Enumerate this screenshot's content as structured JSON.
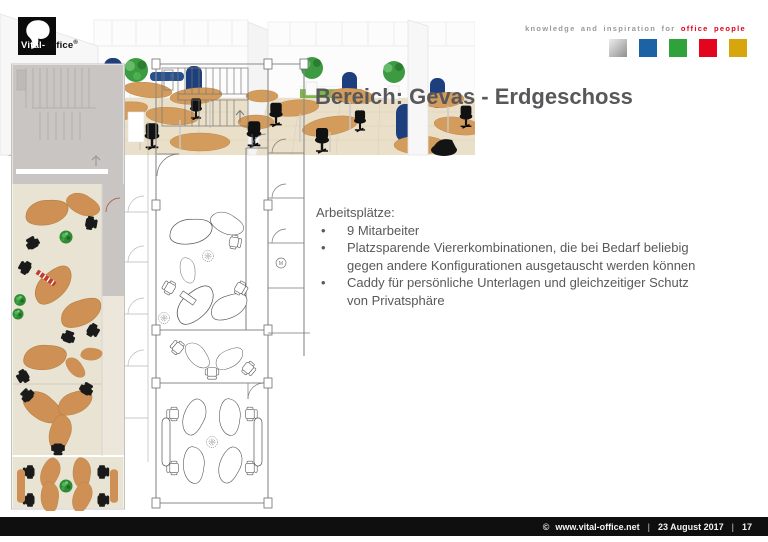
{
  "header": {
    "logo": {
      "white_part": "Vital-",
      "dark_part": "Office",
      "registered_mark": "®"
    },
    "tagline_gray": "knowledge and inspiration for",
    "tagline_red": "office people",
    "palette_squares": [
      {
        "label": "silver",
        "color": "#ededed",
        "color2": "#8f8f8f"
      },
      {
        "label": "blue",
        "color": "#1c63a6"
      },
      {
        "label": "green",
        "color": "#2fa23c"
      },
      {
        "label": "red",
        "color": "#e30520"
      },
      {
        "label": "gold",
        "color": "#d7a60d"
      }
    ]
  },
  "title": "Bereich: Gevas - Erdgeschoss",
  "content": {
    "list_heading": "Arbeitsplätze:",
    "bullet_char": "•",
    "bullets": [
      "9 Mitarbeiter",
      "Platzsparende Viererkombinationen, die bei Bedarf beliebig gegen andere Konfigurationen ausgetauscht werden können",
      "Caddy für persönliche Unterlagen und gleichzeitiger Schutz von Privatsphäre"
    ]
  },
  "floorplans": {
    "stairs_label": "Steig",
    "marker_label": "M"
  },
  "footer": {
    "copyright_symbol": "©",
    "website": "www.vital-office.net",
    "separator": "|",
    "date": "23 August 2017",
    "page_number": "17"
  },
  "colors": {
    "accent_red": "#e2001a",
    "text_gray": "#595959",
    "tagline_gray": "#9a999b",
    "footer_bg": "#0f0f0f",
    "footer_text": "#f2f2f2",
    "desk_tan": "#cf9055",
    "floor_beige": "#e8e3d2",
    "zone_gray": "#c8c5c3",
    "caddy_blue": "#1e3f7d",
    "plant_green": "#2f8a34",
    "floor_3d": "#eadfc8",
    "wall_3d": "#f7f7f7",
    "sideboard_green": "#7cb648"
  }
}
